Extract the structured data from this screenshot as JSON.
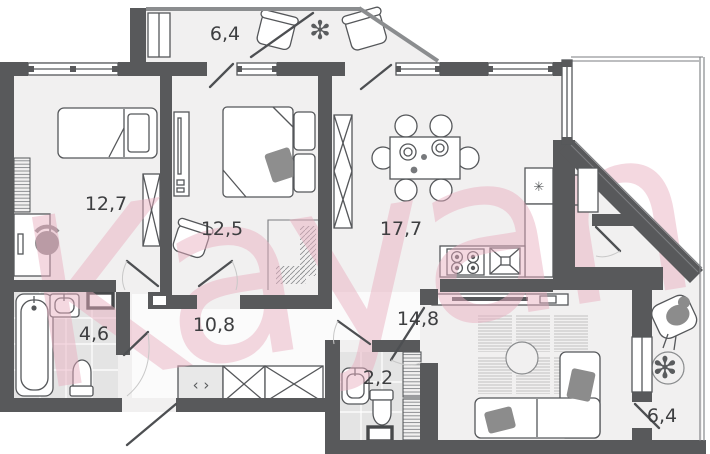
{
  "watermark": "Kayan",
  "rooms": [
    {
      "name": "balcony-top",
      "area_label": "6,4"
    },
    {
      "name": "bedroom-1",
      "area_label": "12,7"
    },
    {
      "name": "bedroom-2",
      "area_label": "12,5"
    },
    {
      "name": "kitchen-dining",
      "area_label": "17,7"
    },
    {
      "name": "bathroom",
      "area_label": "4,6"
    },
    {
      "name": "hallway",
      "area_label": "10,8"
    },
    {
      "name": "living-room",
      "area_label": "14,8"
    },
    {
      "name": "wc",
      "area_label": "2,2"
    },
    {
      "name": "balcony-right",
      "area_label": "6,4"
    }
  ],
  "icons": {
    "fridge_symbol": "✳",
    "plant_symbol": "✻",
    "wardrobe_arrows": "‹ ›"
  },
  "colors": {
    "wall": "#58595b",
    "floor": "#f1f0f0",
    "wet_floor": "#e4e4e4",
    "watermark_pink": "#e9aec0"
  }
}
